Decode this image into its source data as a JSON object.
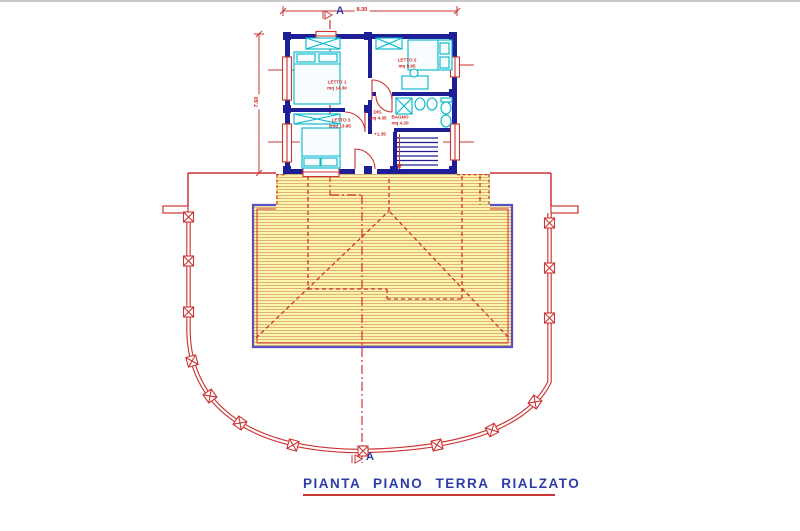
{
  "title": {
    "text": "PIANTA PIANO TERRA RIALZATO"
  },
  "section": {
    "label": "A"
  },
  "dimensions": {
    "top_width": "8.30",
    "left_height": "7.60"
  },
  "level_marker": "+1.35",
  "rooms": [
    {
      "name": "LETTO 1",
      "area": "mq 14.30"
    },
    {
      "name": "LETTO 2",
      "area": "mq 9.95"
    },
    {
      "name": "LETTO 3",
      "area": "mq 13.95"
    },
    {
      "name": "BAGNO",
      "area": "mq 4.20"
    },
    {
      "name": "DIS.",
      "area": "mq 4.35"
    }
  ],
  "colors": {
    "wall_navy": "#1e1e96",
    "furniture_cyan": "#00b6c9",
    "annotation_red": "#cc3333",
    "roof_fill_yellow": "#fcf6a8",
    "roof_hatch": "#e0af7d",
    "roof_border_violet": "#5a4fc0",
    "title_blue": "#2e3ca8"
  }
}
